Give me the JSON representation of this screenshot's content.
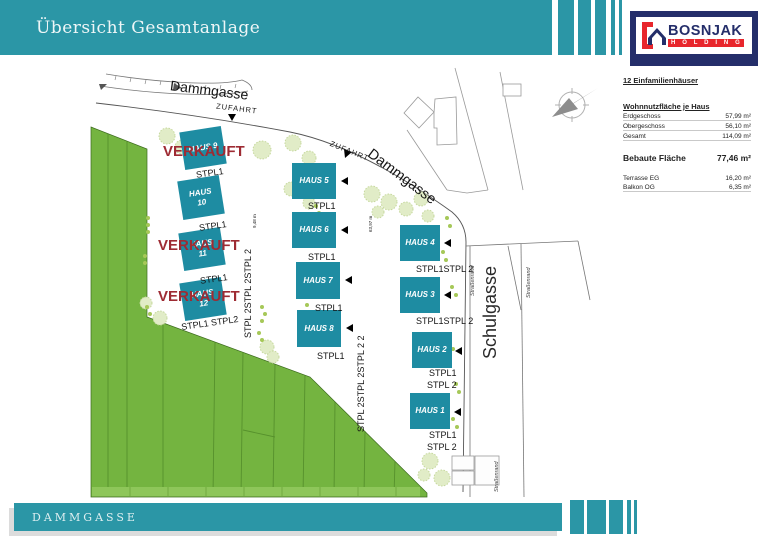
{
  "header": {
    "title": "Übersicht Gesamtanlage"
  },
  "logo": {
    "brand": "BOSNJAK",
    "subbrand": "H O L D I N G"
  },
  "sidebar": {
    "heading": "12 Einfamilienhäuser",
    "usable": {
      "title": "Wohnnutzfläche je Haus",
      "rows": [
        {
          "label": "Erdgeschoss",
          "value": "57,99 m²"
        },
        {
          "label": "Obergeschoss",
          "value": "56,10 m²"
        },
        {
          "label": "Gesamt",
          "value": "114,09 m²"
        }
      ]
    },
    "built": {
      "label": "Bebaute Fläche",
      "value": "77,46 m²"
    },
    "extras": [
      {
        "label": "Terrasse EG",
        "value": "16,20 m²"
      },
      {
        "label": "Balkon   OG",
        "value": "6,35 m²"
      }
    ]
  },
  "plan": {
    "street_top": "Dammgasse",
    "street_right": "Dammgasse",
    "street_schulgasse": "Schulgasse",
    "roadside_label": "Straßenrand",
    "access_label": "ZUFAHRT",
    "sold_label": "VERKAUFT",
    "stpl_single": "STPL1",
    "stpl_two": "STPL 2",
    "stpl_double": "STPL1 STPL2",
    "stpl_double_b": "STPL1STPL 2",
    "stpl_col_left": "STPL 2STPL 2STPL 2",
    "stpl_col_mid": "STPL 2STPL 2STPL 2 2",
    "dim_left": "9,48 m",
    "dim_mid": "63,97 m",
    "houses": [
      {
        "name": "HAUS 1",
        "sold": false
      },
      {
        "name": "HAUS 2",
        "sold": false
      },
      {
        "name": "HAUS 3",
        "sold": false
      },
      {
        "name": "HAUS 4",
        "sold": false
      },
      {
        "name": "HAUS 5",
        "sold": false
      },
      {
        "name": "HAUS 6",
        "sold": false
      },
      {
        "name": "HAUS 7",
        "sold": false
      },
      {
        "name": "HAUS 8",
        "sold": false
      },
      {
        "name": "HAUS 9",
        "sold": true
      },
      {
        "name": "HAUS 10",
        "sold": false
      },
      {
        "name": "HAUS 11",
        "sold": true
      },
      {
        "name": "HAUS 12",
        "sold": true
      }
    ]
  },
  "footer": {
    "street": "DAMMGASSE"
  }
}
